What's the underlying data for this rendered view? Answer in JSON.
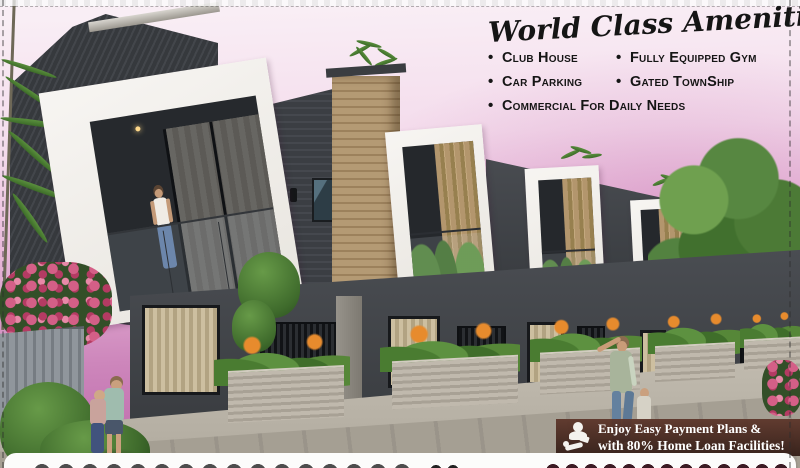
{
  "canvas": {
    "width": 800,
    "height": 468
  },
  "amenities": {
    "title": "World Class Amenities",
    "bullet": "•",
    "rows": [
      {
        "c1": "Club House",
        "c2": "Fully Equipped Gym"
      },
      {
        "c1": "Car Parking",
        "c2": "Gated TownShip"
      }
    ],
    "last_row": "Commercial For Daily Needs"
  },
  "offer": {
    "line1": "Enjoy Easy Payment Plans &",
    "line2": "with 80% Home Loan Facilities!",
    "icon": "home-loan-hand-coins-icon"
  },
  "colors": {
    "sky_top": "#f9eef5",
    "sky_deep": "#bf6cad",
    "wall_dark": "#3d4045",
    "frame_white": "#f3f1ee",
    "wood_panel": "#b2976f",
    "foliage": "#4e7c36",
    "flower_pink": "#d45f87",
    "flower_orange": "#e78b2d",
    "walkway": "#c4beb2",
    "banner_bg": "#3f241d",
    "banner_text": "#ffffff",
    "amenities_text": "#151515"
  }
}
